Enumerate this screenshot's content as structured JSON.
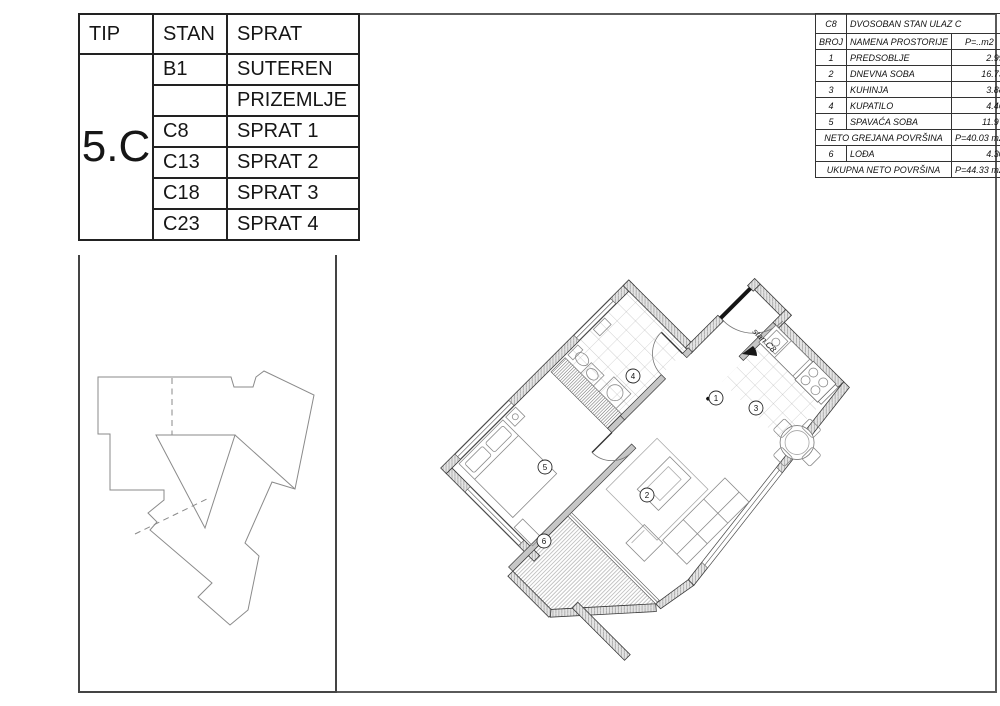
{
  "left_table": {
    "headers": [
      "TIP",
      "STAN",
      "SPRAT"
    ],
    "tip": "5.C",
    "rows": [
      {
        "stan": "B1",
        "sprat": "SUTEREN"
      },
      {
        "stan": "",
        "sprat": "PRIZEMLJE"
      },
      {
        "stan": "C8",
        "sprat": "SPRAT 1"
      },
      {
        "stan": "C13",
        "sprat": "SPRAT 2"
      },
      {
        "stan": "C18",
        "sprat": "SPRAT 3"
      },
      {
        "stan": "C23",
        "sprat": "SPRAT 4"
      }
    ]
  },
  "right_table": {
    "unit_id": "C8",
    "unit_title": "DVOSOBAN STAN ULAZ C",
    "col_headers": [
      "BROJ",
      "NAMENA PROSTORIJE",
      "P=..m2"
    ],
    "rooms": [
      [
        "1",
        "PREDSOBLJE",
        "2.99"
      ],
      [
        "2",
        "DNEVNA SOBA",
        "16.73"
      ],
      [
        "3",
        "KUHINJA",
        "3.88"
      ],
      [
        "4",
        "KUPATILO",
        "4.46"
      ],
      [
        "5",
        "SPAVAĆA SOBA",
        "11.97"
      ]
    ],
    "neto_label": "NETO GREJANA POVRŠINA",
    "neto_value": "P=40.03 m2",
    "loggia_row": [
      "6",
      "LOĐA",
      "4.30"
    ],
    "ukupna_label": "UKUPNA NETO POVRŠINA",
    "ukupna_value": "P=44.33 m2"
  },
  "floor_plan": {
    "entrance_label": "stan C8",
    "room_markers": [
      {
        "no": "1",
        "x": 276,
        "y": 138
      },
      {
        "no": "2",
        "x": 207,
        "y": 235
      },
      {
        "no": "3",
        "x": 316,
        "y": 148
      },
      {
        "no": "4",
        "x": 193,
        "y": 116
      },
      {
        "no": "5",
        "x": 105,
        "y": 207
      },
      {
        "no": "6",
        "x": 104,
        "y": 281
      }
    ]
  }
}
